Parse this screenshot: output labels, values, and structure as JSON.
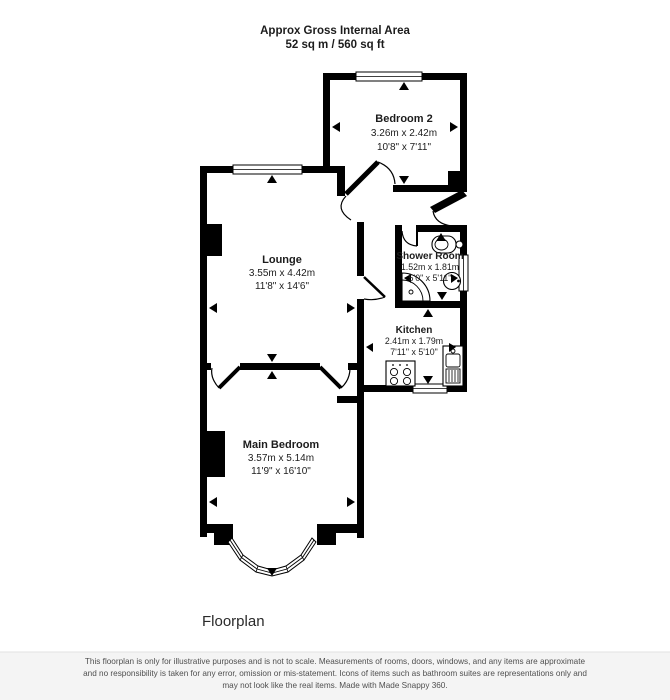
{
  "header": {
    "line1": "Approx Gross Internal Area",
    "line2": "52 sq m / 560 sq ft"
  },
  "rooms": {
    "bedroom2": {
      "name": "Bedroom 2",
      "metric": "3.26m x 2.42m",
      "imperial": "10'8\" x 7'11\""
    },
    "lounge": {
      "name": "Lounge",
      "metric": "3.55m x 4.42m",
      "imperial": "11'8\" x 14'6\""
    },
    "shower_room": {
      "name": "Shower Room",
      "metric": "1.52m x 1.81m",
      "imperial": "5'0\" x 5'11\""
    },
    "kitchen": {
      "name": "Kitchen",
      "metric": "2.41m x 1.79m",
      "imperial": "7'11\" x 5'10\""
    },
    "main_bedroom": {
      "name": "Main Bedroom",
      "metric": "3.57m x 5.14m",
      "imperial": "11'9\" x 16'10\""
    }
  },
  "footer": {
    "caption": "Floorplan",
    "disclaimer_line1": "This floorplan is only for illustrative purposes and is not to scale. Measurements of rooms, doors, windows, and any items are approximate",
    "disclaimer_line2": "and no responsibility is taken for any error, omission or mis-statement. Icons of items such as bathroom suites are representations only and",
    "disclaimer_line3": "may not look like the real items. Made with Made Snappy 360."
  },
  "colors": {
    "wall": "#000000",
    "background": "#ffffff",
    "disclaimer_text": "#4f4f4f"
  }
}
